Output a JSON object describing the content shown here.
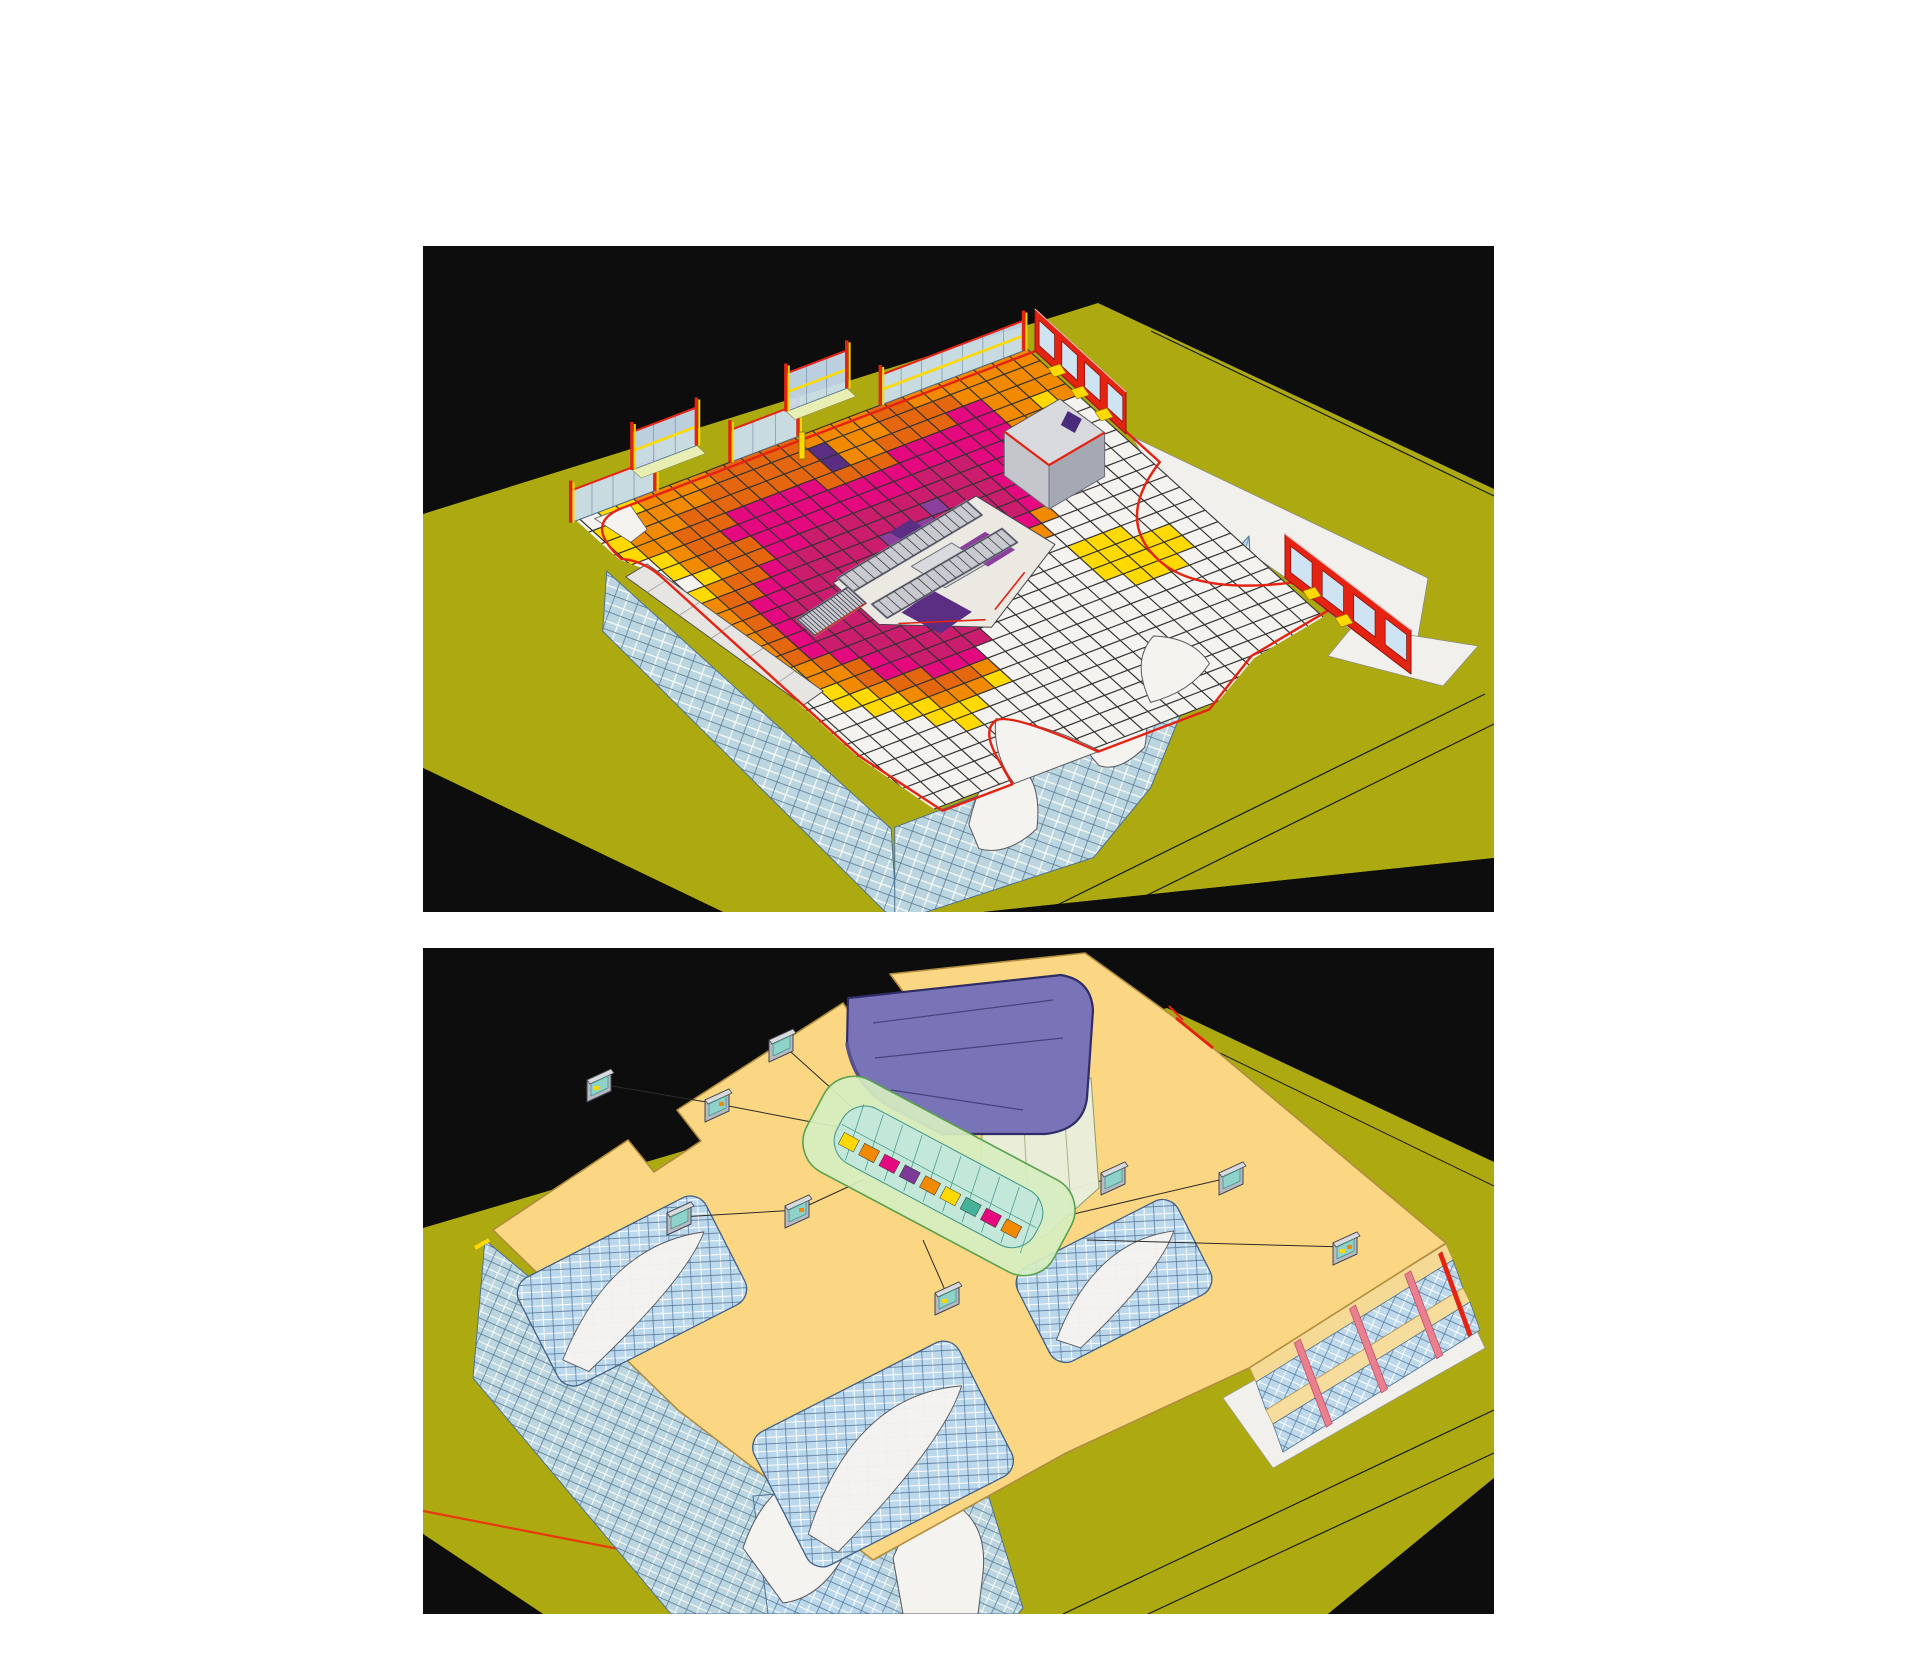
{
  "figure": {
    "panel_width": 1071,
    "panel_height": 666,
    "panels": [
      {
        "id": "daylight-heatmap-view",
        "description": "3D cutaway view of building floor with illuminance heatmap grid, central escalators, glazed facades and red floor outline on olive site plane",
        "x": 423,
        "y": 246
      },
      {
        "id": "roof-view",
        "description": "3D aerial view of same building roof with cream roof plate, purple atrium canopy, green glazed atrium vault, gray skylight monitors and leader lines on olive site plane",
        "x": 423,
        "y": 948
      }
    ]
  },
  "colors": {
    "page_bg": "#ffffff",
    "panel_bg": "#0d0d0d",
    "ground": "#adaa11",
    "ground_line": "#1b1b1b",
    "floor_white": "#f5f3ef",
    "grid_line": "#333333",
    "glass": "#c9dff0",
    "glass_deep": "#bcd8ec",
    "glass_line": "#4d7093",
    "mullion_white": "#ffffff",
    "red": "#e42313",
    "red_site_line": "#e8380d",
    "yellow": "#ffd900",
    "yellow_pale": "#e9efb4",
    "orange": "#f18a00",
    "orange_deep": "#e4670f",
    "magenta": "#e5097f",
    "crimson": "#cb1d6e",
    "purple": "#8c3f9e",
    "violet": "#5b2d83",
    "gray_light": "#d9dadd",
    "gray_mid": "#b7bac3",
    "gray_dark": "#8f93a0",
    "outline_dark": "#44464f",
    "roof": "#fbd783",
    "roof_edge": "#b08d3e",
    "canopy": "#7974b7",
    "canopy_line": "#2f2c67",
    "canopy_shade": "#55518f",
    "drum": "#e9eedd",
    "green_glass": "#d6eec0",
    "green_line": "#58a14e",
    "teal_glass": "#c2e7da",
    "teal_line": "#3f958a",
    "teal_light": "#8fd2c9",
    "pink": "#e8808f",
    "plaza": "#f1f0ec"
  },
  "heatmap": {
    "cols": 26,
    "rows": 26,
    "palette": {
      ".": "#f5f3ef",
      "y": "#ffd900",
      "o": "#f18a00",
      "d": "#e4670f",
      "m": "#e5097f",
      "c": "#cb1d6e",
      "p": "#8c3f9e",
      "v": "#5b2d83"
    },
    "matrix": [
      "..yyoooodddddooooddooooooo",
      ".yyooooddddddvoooddddooooo",
      ".yoooddddddddvooddddmmoooo",
      ".yoodddmmmmmddddmmmmmmooyo",
      "..yoddmmmmmmmmmmmmmmmmooy.",
      "..yodddmmmmmmmmmcccmmmoo..",
      "...yoddmmccccccccccmmoo...",
      "..yoddmccccccccpcccmmo....",
      ".yoddmmcccccpvpccccmo.....",
      ".yodmmcccccpvvvpcccmo.....",
      ".yodmccccccpvvvpccmo......",
      ".yodmcccccccpvpcmmo.......",
      ".yodmcccccccvvcmo.........",
      ".yodmccccccccpco...yyy....",
      "..yodmcccccccc.....yyyyy..",
      "..yoodmcccccc......yyyyy..",
      "...yodmmcccc........yyy...",
      "...yyoddmmm...............",
      "....yyodddo...............",
      ".....yyoooy...............",
      "......yyy.................",
      ".......y..................",
      "..........................",
      "..........................",
      "..........................",
      ".........................."
    ]
  },
  "roof_monitors": {
    "positions": [
      [
        177,
        130
      ],
      [
        295,
        150
      ],
      [
        359,
        90
      ],
      [
        621,
        37
      ],
      [
        257,
        263
      ],
      [
        375,
        256
      ],
      [
        525,
        343
      ],
      [
        691,
        223
      ],
      [
        809,
        223
      ],
      [
        923,
        293
      ]
    ],
    "leader_lines": [
      [
        [
          177,
          136
        ],
        [
          295,
          156
        ]
      ],
      [
        [
          295,
          156
        ],
        [
          420,
          180
        ]
      ],
      [
        [
          359,
          96
        ],
        [
          430,
          160
        ]
      ],
      [
        [
          257,
          269
        ],
        [
          375,
          262
        ]
      ],
      [
        [
          375,
          262
        ],
        [
          440,
          232
        ]
      ],
      [
        [
          525,
          349
        ],
        [
          500,
          292
        ]
      ],
      [
        [
          691,
          229
        ],
        [
          612,
          252
        ]
      ],
      [
        [
          809,
          229
        ],
        [
          642,
          268
        ]
      ],
      [
        [
          923,
          299
        ],
        [
          664,
          292
        ]
      ],
      [
        [
          621,
          43
        ],
        [
          566,
          84
        ]
      ]
    ]
  }
}
